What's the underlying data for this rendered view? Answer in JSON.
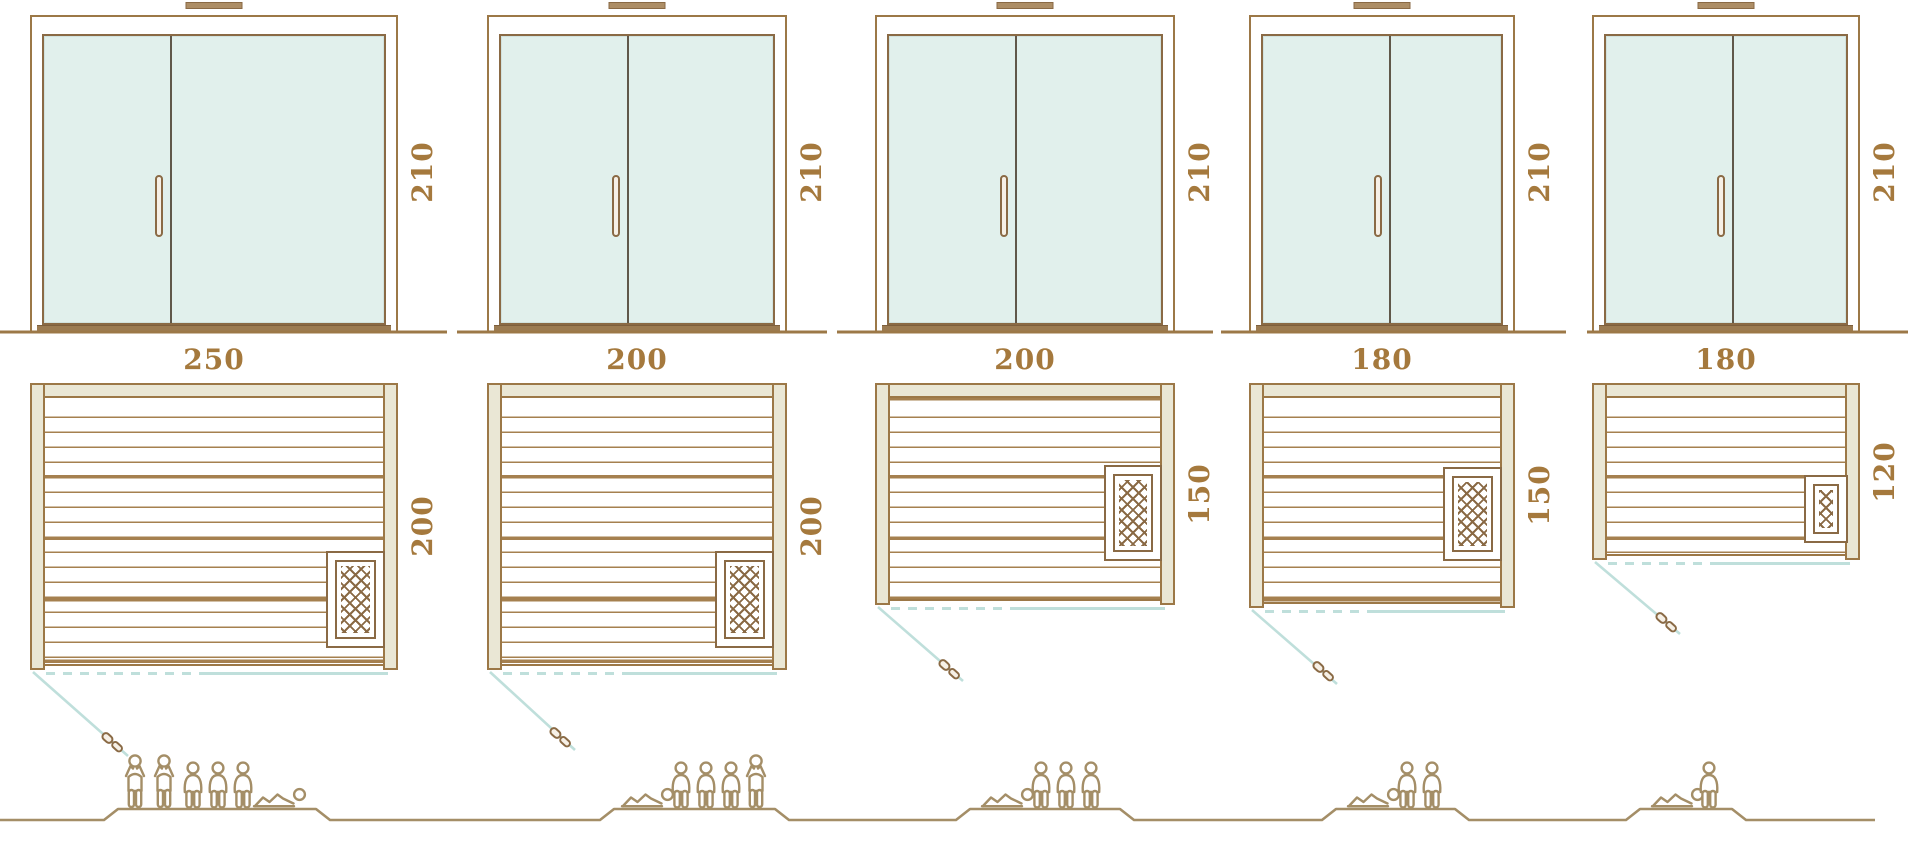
{
  "diagram": {
    "type": "sauna-size-comparison",
    "rows": [
      "door-elevations",
      "floor-plans",
      "capacity-figures"
    ],
    "dimension_labels_color": "#a5793d"
  },
  "colors": {
    "line_brown": "#9c7847",
    "dark_brown": "#8a6a45",
    "wall_fill": "#eae7d5",
    "glass": "#e1f0ec",
    "swing_teal": "#bfdfdb",
    "label_text": "#a5793d",
    "people_outline": "#a48e67"
  },
  "icons": {
    "heater": "crosshatch-square",
    "door_swing": "diagonal-teal-line",
    "door_handle_plan": "lever-handle",
    "roof_vent": "small-filled-rectangle",
    "person_standing": "outline-figure-arms-up",
    "person_sitting": "outline-figure-seated",
    "person_lying": "outline-figure-reclining"
  },
  "units": [
    {
      "name": "sauna-250x200",
      "width_label": "250",
      "depth_label": "200",
      "door_height_label": "210",
      "capacity_persons": 6,
      "capacity_breakdown": {
        "standing": 2,
        "sitting": 3,
        "lying": 1
      }
    },
    {
      "name": "sauna-200x200",
      "width_label": "200",
      "depth_label": "200",
      "door_height_label": "210",
      "capacity_persons": 5,
      "capacity_breakdown": {
        "standing": 1,
        "sitting": 3,
        "lying": 1
      }
    },
    {
      "name": "sauna-200x150",
      "width_label": "200",
      "depth_label": "150",
      "door_height_label": "210",
      "capacity_persons": 4,
      "capacity_breakdown": {
        "standing": 0,
        "sitting": 3,
        "lying": 1
      }
    },
    {
      "name": "sauna-180x150",
      "width_label": "180",
      "depth_label": "150",
      "door_height_label": "210",
      "capacity_persons": 3,
      "capacity_breakdown": {
        "standing": 0,
        "sitting": 2,
        "lying": 1
      }
    },
    {
      "name": "sauna-180x120",
      "width_label": "180",
      "depth_label": "120",
      "door_height_label": "210",
      "capacity_persons": 2,
      "capacity_breakdown": {
        "standing": 0,
        "sitting": 1,
        "lying": 1
      }
    }
  ]
}
